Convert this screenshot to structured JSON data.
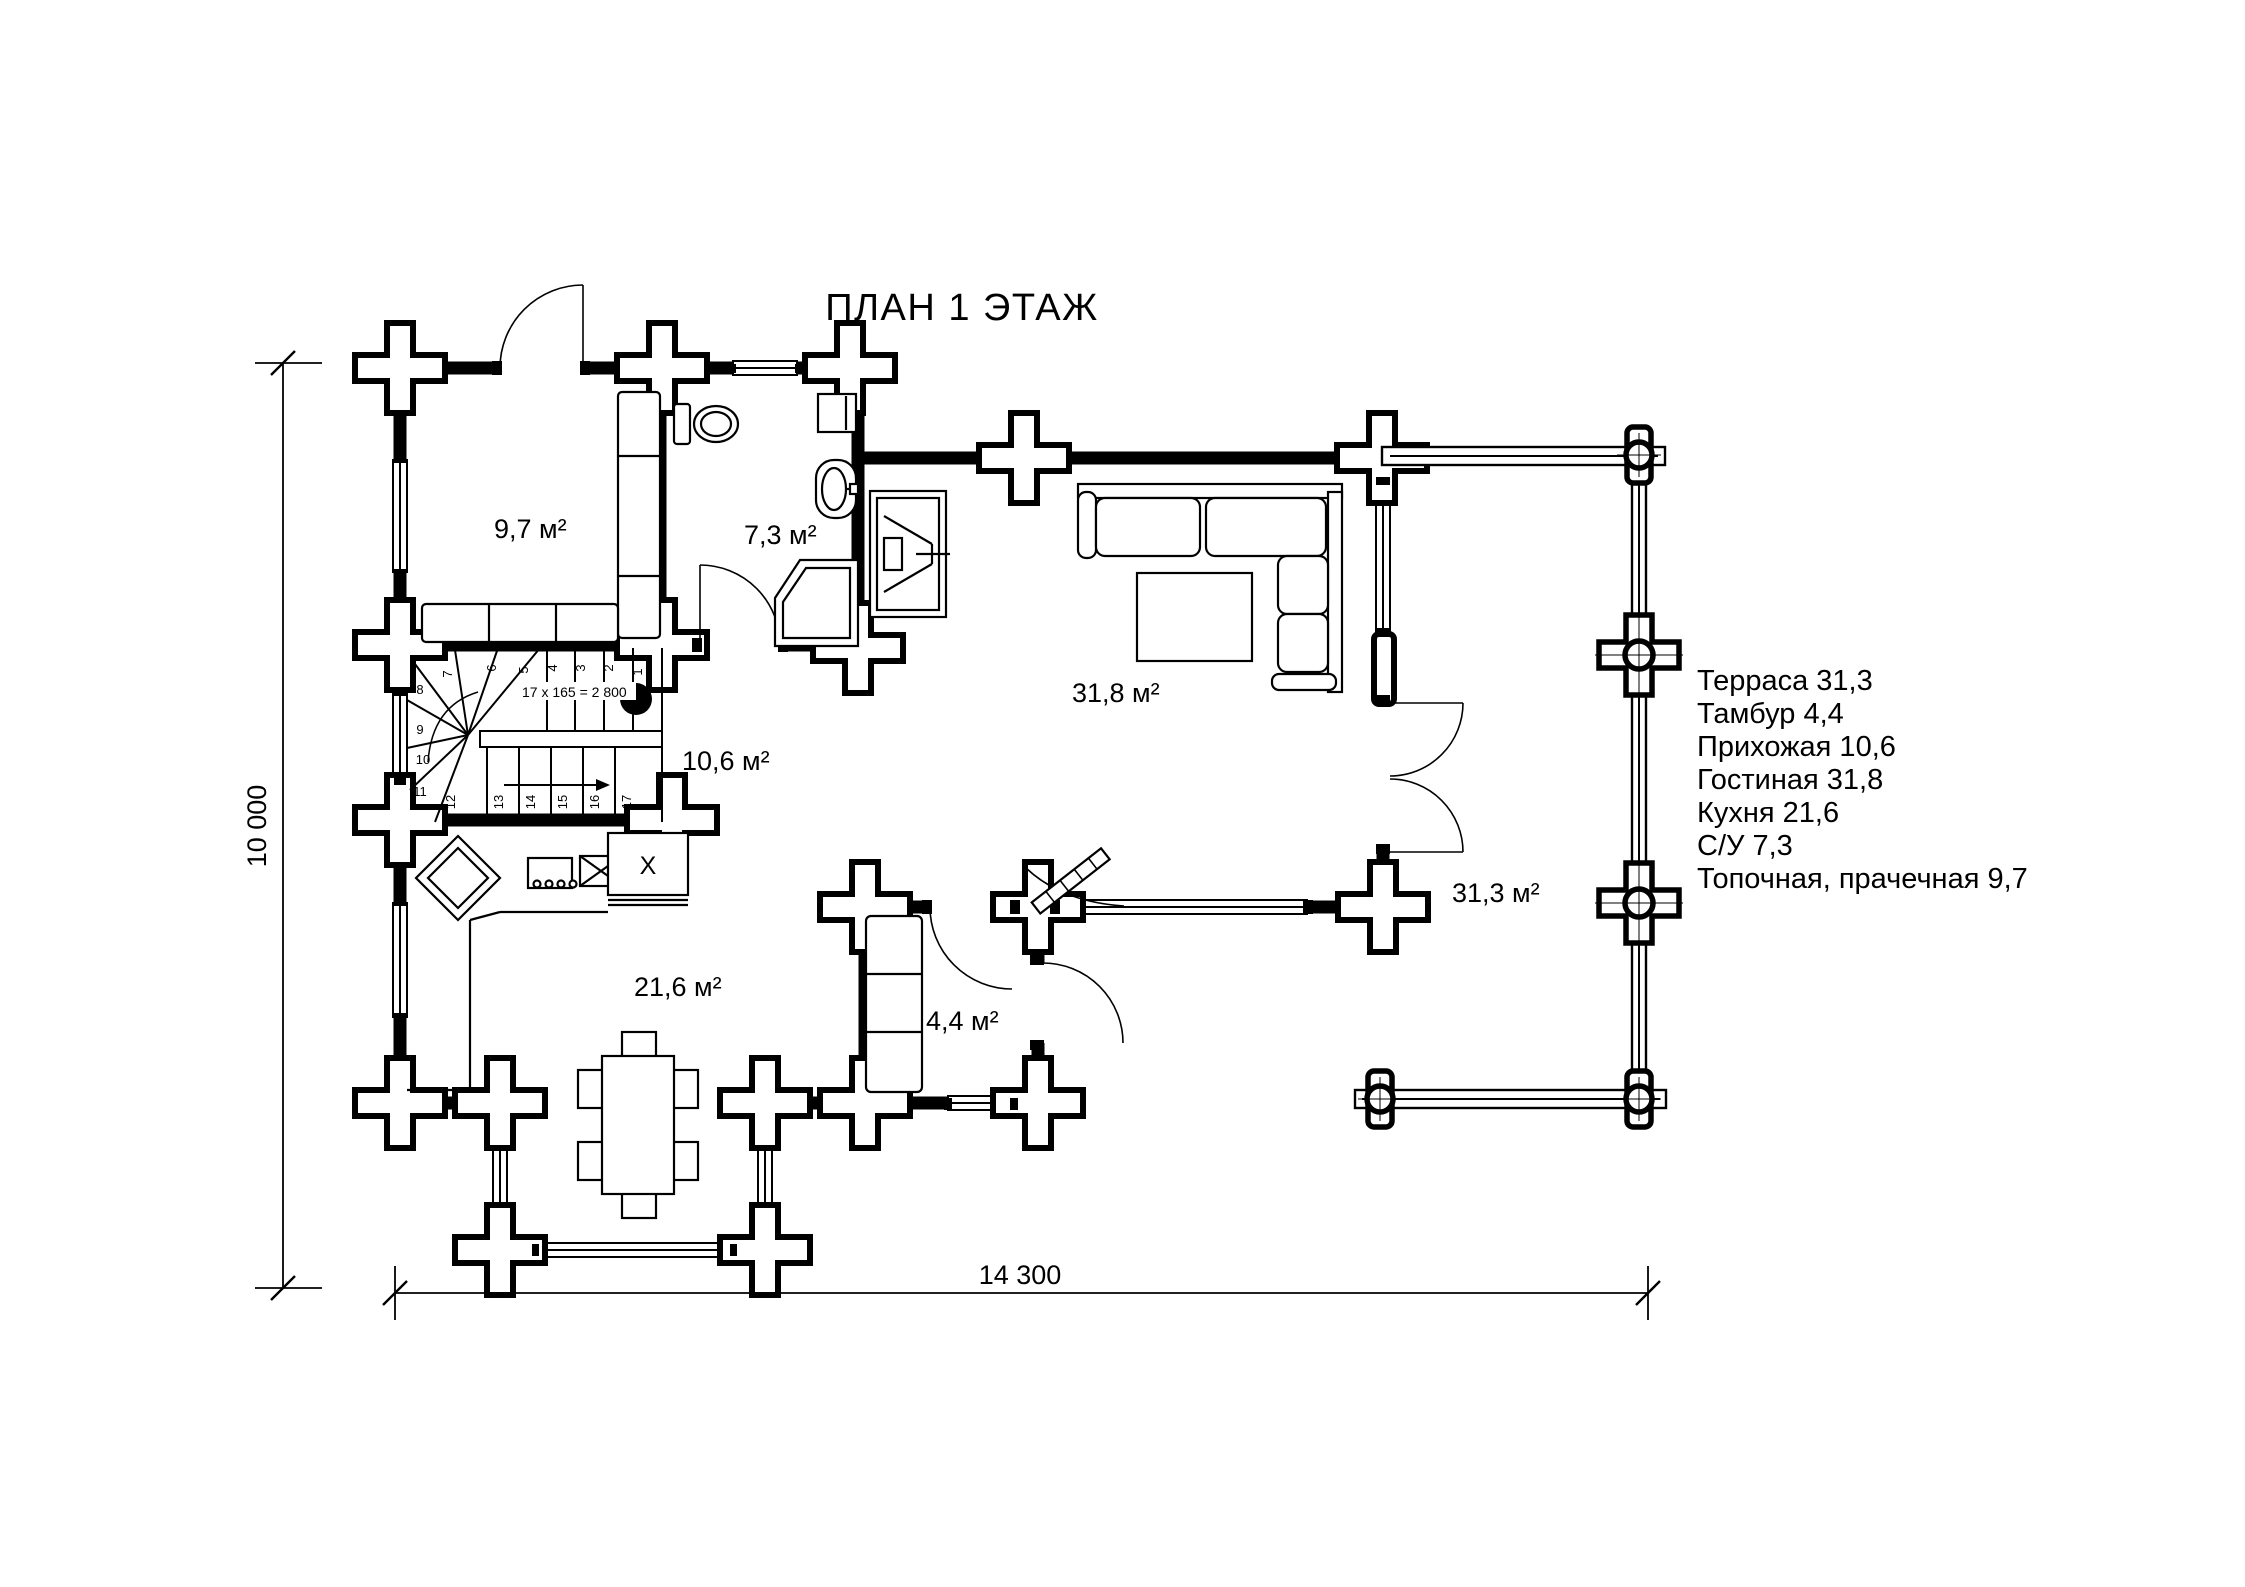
{
  "title": "ПЛАН 1 ЭТАЖ",
  "legend": {
    "items": [
      "Терраса 31,3",
      "Тамбур 4,4",
      "Прихожая 10,6",
      "Гостиная 31,8",
      "Кухня 21,6",
      "С/У 7,3",
      "Топочная, прачечная 9,7"
    ]
  },
  "rooms": {
    "boiler_laundry": "9,7 м²",
    "bathroom": "7,3 м²",
    "living_room": "31,8 м²",
    "entrance_hall": "10,6 м²",
    "kitchen": "21,6 м²",
    "vestibule": "4,4 м²",
    "terrace": "31,3 м²"
  },
  "dimensions": {
    "horizontal": "14 300",
    "vertical": "10 000"
  },
  "stairs": {
    "formula": "17 x 165 = 2 800",
    "steps": [
      "1",
      "2",
      "3",
      "4",
      "5",
      "6",
      "7",
      "8",
      "9",
      "10",
      "11",
      "12",
      "13",
      "14",
      "15",
      "16",
      "17"
    ]
  },
  "appliances": {
    "fridge": "X"
  }
}
